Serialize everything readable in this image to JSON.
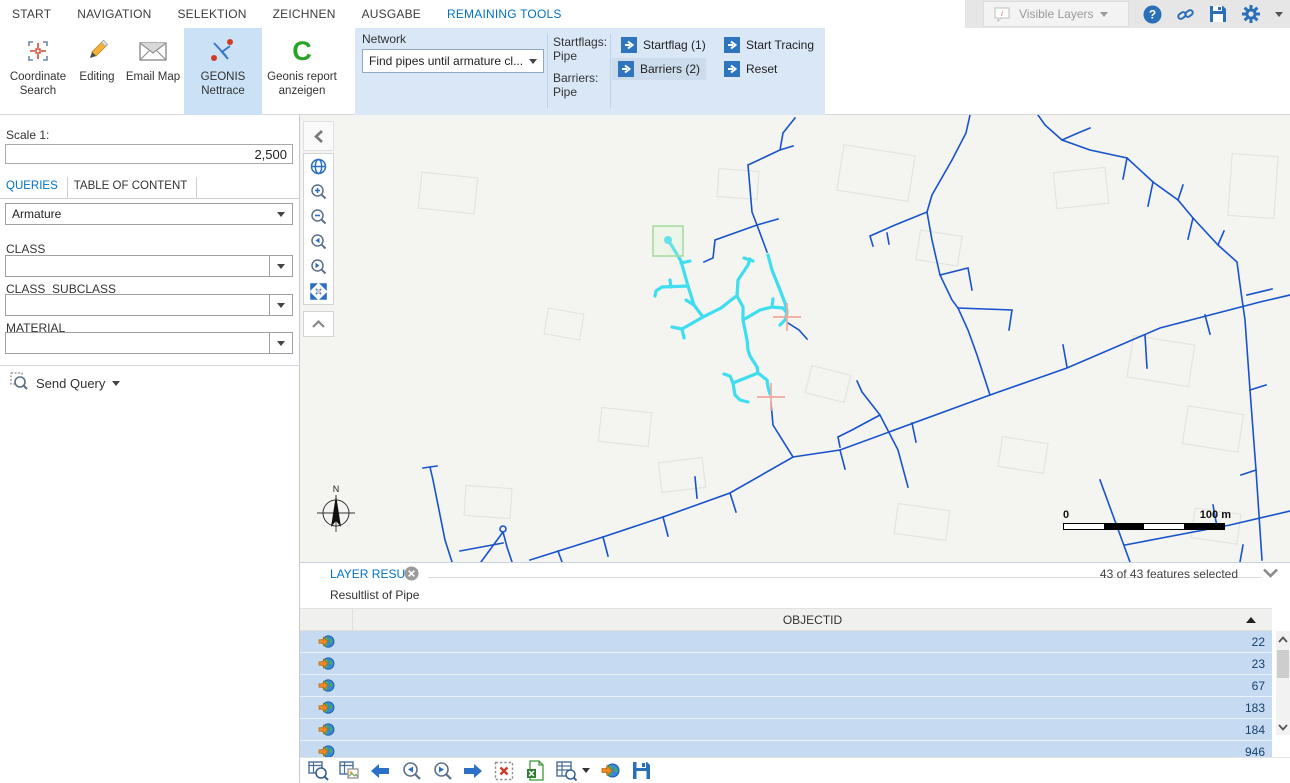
{
  "menu": {
    "tabs": [
      {
        "label": "START"
      },
      {
        "label": "NAVIGATION"
      },
      {
        "label": "SELEKTION"
      },
      {
        "label": "ZEICHNEN"
      },
      {
        "label": "AUSGABE"
      },
      {
        "label": "REMAINING TOOLS"
      }
    ],
    "active_tab": "REMAINING TOOLS"
  },
  "titlebar": {
    "visible_layers_label": "Visible Layers",
    "icons": [
      "callout-info-icon",
      "help-icon",
      "link-icon",
      "save-icon",
      "gear-icon",
      "collapse-ribbon-icon"
    ]
  },
  "ribbon": {
    "buttons": {
      "coordinate_search": "Coordinate\nSearch",
      "editing": "Editing",
      "email_map": "Email Map",
      "geonis_nettrace": "GEONIS\nNettrace",
      "geonis_report": "Geonis report\nanzeigen"
    },
    "network_group": {
      "label": "Network",
      "dropdown_value": "Find pipes until armature cl..."
    },
    "flags": {
      "startflags_label": "Startflags:",
      "startflags_value": "Pipe",
      "barriers_label": "Barriers:",
      "barriers_value": "Pipe"
    },
    "actions": {
      "startflag": "Startflag (1)",
      "barriers": "Barriers (2)",
      "start_tracing": "Start Tracing",
      "reset": "Reset"
    }
  },
  "left_panel": {
    "scale_label": "Scale 1:",
    "scale_value": "2,500",
    "tabs": [
      {
        "label": "QUERIES"
      },
      {
        "label": "TABLE OF CONTENT"
      }
    ],
    "query_select_value": "Armature",
    "fields": [
      {
        "label": "CLASS",
        "value": ""
      },
      {
        "label": "CLASS_SUBCLASS",
        "value": ""
      },
      {
        "label": "MATERIAL",
        "value": ""
      }
    ],
    "send_query_label": "Send Query"
  },
  "map": {
    "compass_label": "N",
    "scalebar": {
      "start": "0",
      "end": "100 m"
    },
    "tool_icons": [
      "globe-icon",
      "zoom-in-icon",
      "zoom-out-icon",
      "previous-extent-icon",
      "next-extent-icon",
      "full-extent-icon"
    ]
  },
  "layer_result": {
    "title": "LAYER RESULT",
    "selection_summary": "43 of 43 features selected",
    "subtitle": "Resultlist of Pipe",
    "table": {
      "column": "OBJECTID",
      "rows": [
        "22",
        "23",
        "67",
        "183",
        "184",
        "946"
      ]
    }
  },
  "footer_icons": [
    "zoom-to-selection-table-icon",
    "show-form-icon",
    "previous-record-icon",
    "zoom-previous-icon",
    "zoom-next-icon",
    "next-record-icon",
    "clear-selection-icon",
    "export-excel-icon",
    "report-table-icon",
    "zoom-to-all-icon",
    "save-results-icon"
  ],
  "colors": {
    "accent_blue": "#0072c6",
    "ribbon_panel": "#d9e7f7",
    "button_blue": "#2e75be",
    "pipe_blue": "#1853cb",
    "trace_cyan": "#3eddf0",
    "barrier_salmon": "#f2a79e",
    "startflag_green": "#a6dca0",
    "row_selected": "#c6dbf2"
  }
}
